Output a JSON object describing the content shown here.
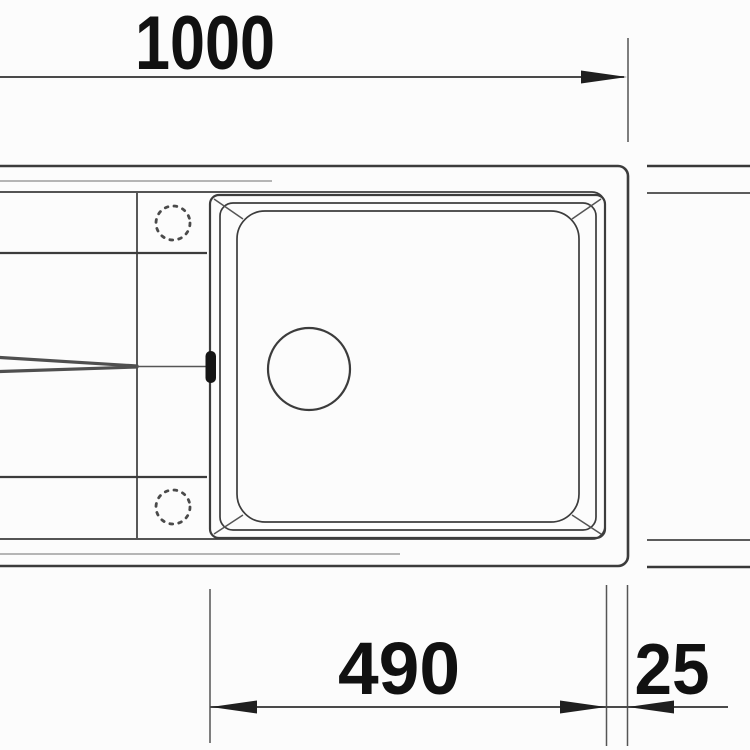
{
  "drawing": {
    "kind": "sink-plan-view-technical-drawing",
    "dimension_labels": {
      "overall_width": "1000",
      "bowl_width": "490",
      "rim_offset": "25"
    },
    "colors": {
      "line": "#3c3c3c",
      "text": "#111111",
      "background": "#fcfcfc"
    }
  }
}
